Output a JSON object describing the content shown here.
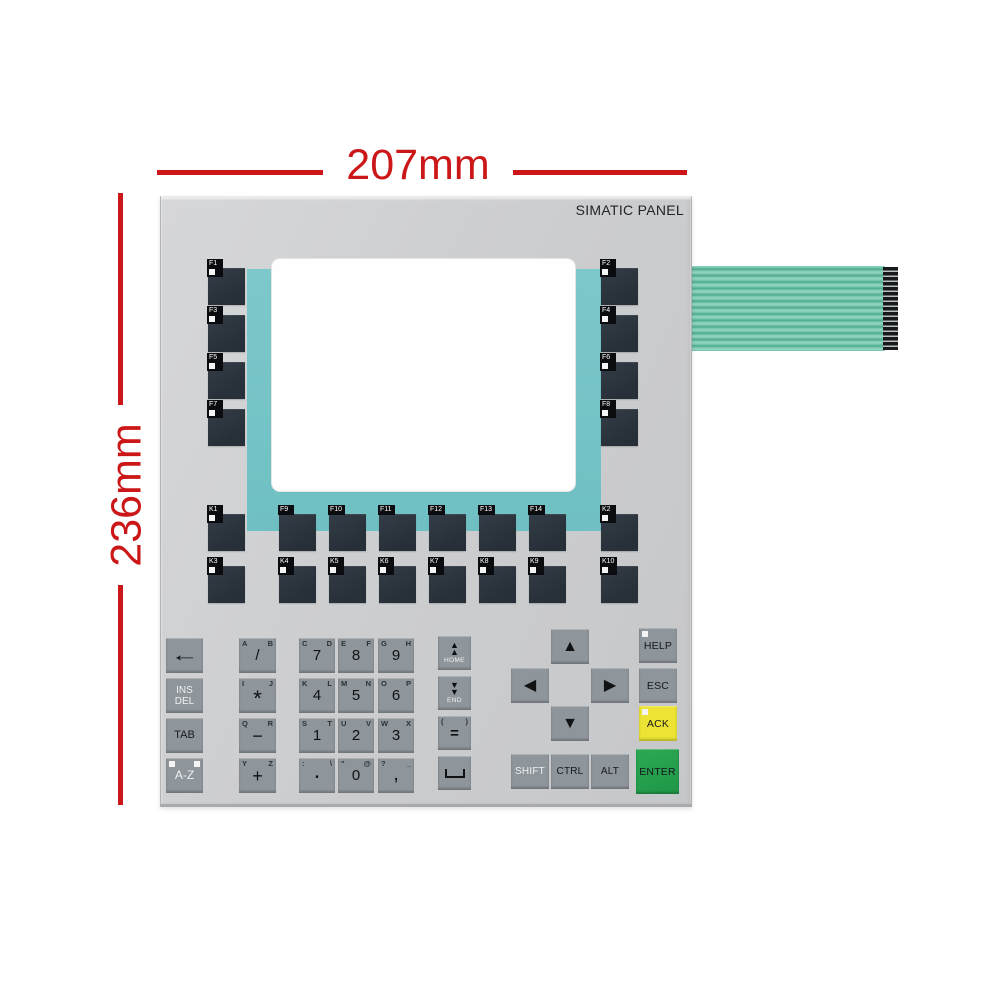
{
  "annotations": {
    "width_label": "207mm",
    "height_label": "236mm",
    "color": "#cb1718"
  },
  "panel": {
    "brand": "SIMATIC PANEL",
    "colors": {
      "panel_gray": "#cdced0",
      "bezel_teal": "#74c3c6",
      "dark_key": "#2b343d",
      "gray_key": "#8e959b",
      "ack_yellow": "#ece334",
      "enter_green": "#26a14e",
      "ribbon_teal": "#7ecabb"
    },
    "fkeys_left": [
      {
        "id": "f1",
        "label": "F1",
        "led": true
      },
      {
        "id": "f3",
        "label": "F3",
        "led": true
      },
      {
        "id": "f5",
        "label": "F5",
        "led": true
      },
      {
        "id": "f7",
        "label": "F7",
        "led": true
      }
    ],
    "fkeys_right": [
      {
        "id": "f2",
        "label": "F2",
        "led": true
      },
      {
        "id": "f4",
        "label": "F4",
        "led": true
      },
      {
        "id": "f6",
        "label": "F6",
        "led": true
      },
      {
        "id": "f8",
        "label": "F8",
        "led": true
      }
    ],
    "krow_top": [
      {
        "id": "k1",
        "label": "K1",
        "led": true
      },
      {
        "id": "f9",
        "label": "F9",
        "led": false
      },
      {
        "id": "f10",
        "label": "F10",
        "led": false
      },
      {
        "id": "f11",
        "label": "F11",
        "led": false
      },
      {
        "id": "f12",
        "label": "F12",
        "led": false
      },
      {
        "id": "f13",
        "label": "F13",
        "led": false
      },
      {
        "id": "f14",
        "label": "F14",
        "led": false
      },
      {
        "id": "k2",
        "label": "K2",
        "led": true
      }
    ],
    "krow_bottom": [
      {
        "id": "k3",
        "label": "K3",
        "led": true
      },
      {
        "id": "k4",
        "label": "K4",
        "led": true
      },
      {
        "id": "k5",
        "label": "K5",
        "led": true
      },
      {
        "id": "k6",
        "label": "K6",
        "led": true
      },
      {
        "id": "k7",
        "label": "K7",
        "led": true
      },
      {
        "id": "k8",
        "label": "K8",
        "led": true
      },
      {
        "id": "k9",
        "label": "K9",
        "led": true
      },
      {
        "id": "k10",
        "label": "K10",
        "led": true
      }
    ],
    "edit_column": [
      {
        "id": "backspace",
        "center": "←"
      },
      {
        "id": "ins-del",
        "lines": [
          "INS",
          "DEL"
        ]
      },
      {
        "id": "tab",
        "lines": [
          "TAB"
        ]
      },
      {
        "id": "a-z",
        "lines": [
          "A-Z"
        ],
        "leds": 2
      }
    ],
    "symbol_column": [
      {
        "id": "slash",
        "corner_left": "A",
        "corner_right": "B",
        "center": "/"
      },
      {
        "id": "asterisk",
        "corner_left": "I",
        "corner_right": "J",
        "center": "*"
      },
      {
        "id": "minus",
        "corner_left": "Q",
        "corner_right": "R",
        "center": "−"
      },
      {
        "id": "plus",
        "corner_left": "Y",
        "corner_right": "Z",
        "center": "+"
      }
    ],
    "numpad": [
      {
        "id": "7",
        "corner_left": "C",
        "corner_right": "D",
        "center": "7"
      },
      {
        "id": "8",
        "corner_left": "E",
        "corner_right": "F",
        "center": "8"
      },
      {
        "id": "9",
        "corner_left": "G",
        "corner_right": "H",
        "center": "9"
      },
      {
        "id": "4",
        "corner_left": "K",
        "corner_right": "L",
        "center": "4"
      },
      {
        "id": "5",
        "corner_left": "M",
        "corner_right": "N",
        "center": "5"
      },
      {
        "id": "6",
        "corner_left": "O",
        "corner_right": "P",
        "center": "6"
      },
      {
        "id": "1",
        "corner_left": "S",
        "corner_right": "T",
        "center": "1"
      },
      {
        "id": "2",
        "corner_left": "U",
        "corner_right": "V",
        "center": "2"
      },
      {
        "id": "3",
        "corner_left": "W",
        "corner_right": "X",
        "center": "3"
      },
      {
        "id": "dot",
        "corner_left": ":",
        "corner_right": "\\",
        "center": "."
      },
      {
        "id": "0",
        "corner_left": "\"",
        "corner_right": "@",
        "center": "0"
      },
      {
        "id": "comma",
        "corner_left": "?",
        "corner_right": "_",
        "center": ","
      }
    ],
    "nav_column": [
      {
        "id": "home",
        "arrows": "up",
        "label": "HOME"
      },
      {
        "id": "end",
        "arrows": "down",
        "label": "END"
      },
      {
        "id": "equals",
        "corner_left": "(",
        "corner_right": ")",
        "center": "="
      },
      {
        "id": "space",
        "space": true
      }
    ],
    "arrow_cluster": [
      {
        "id": "arrow-up",
        "center": "▲"
      },
      {
        "id": "arrow-left",
        "center": "◀"
      },
      {
        "id": "arrow-right",
        "center": "▶"
      },
      {
        "id": "arrow-down",
        "center": "▼"
      }
    ],
    "modifiers": [
      {
        "id": "shift",
        "label": "SHIFT"
      },
      {
        "id": "ctrl",
        "label": "CTRL"
      },
      {
        "id": "alt",
        "label": "ALT"
      }
    ],
    "action_column": [
      {
        "id": "help",
        "label": "HELP",
        "led": true
      },
      {
        "id": "esc",
        "label": "ESC"
      },
      {
        "id": "ack",
        "label": "ACK",
        "led": true
      },
      {
        "id": "enter",
        "label": "ENTER"
      }
    ]
  }
}
